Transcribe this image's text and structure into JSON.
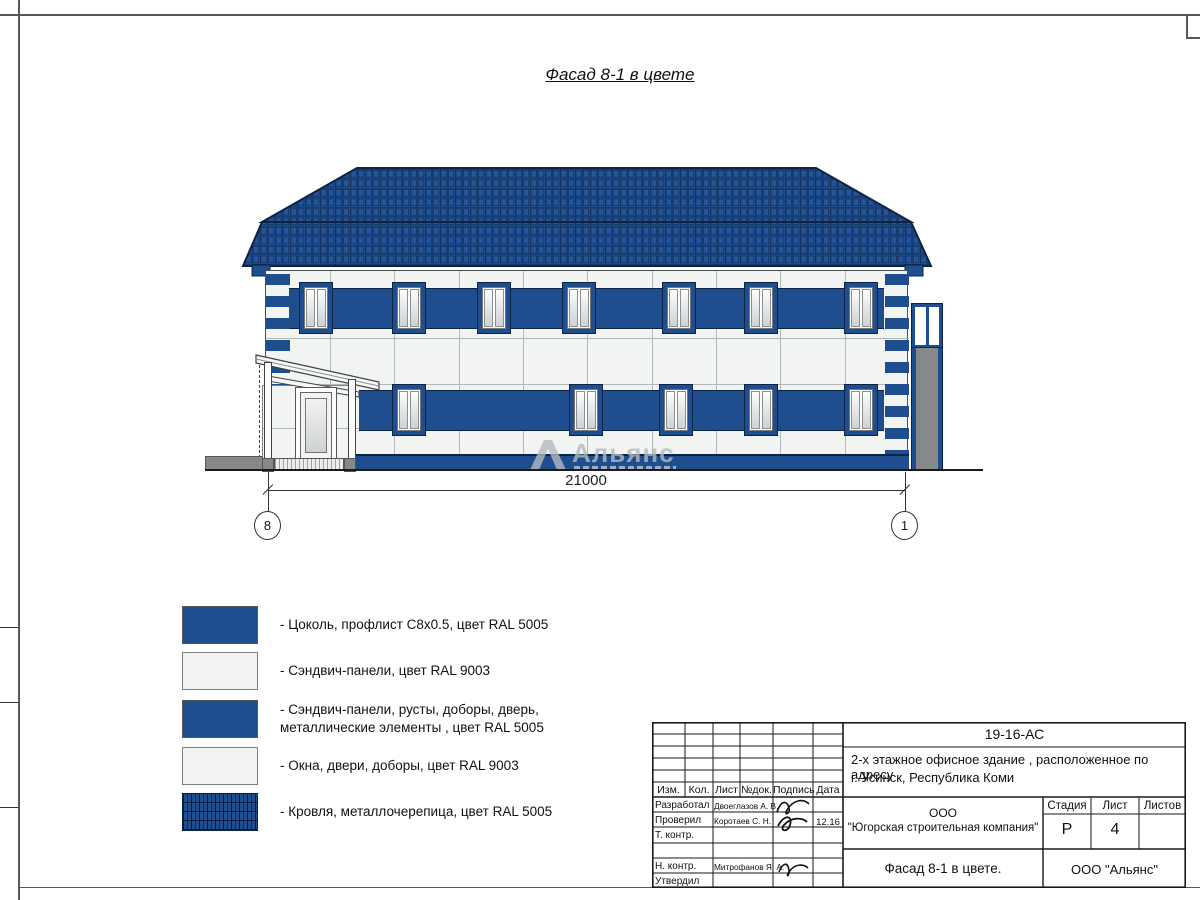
{
  "page": {
    "drawing_title": "Фасад 8-1 в цвете"
  },
  "drawing": {
    "dimension_label": "21000",
    "axis_left": "8",
    "axis_right": "1",
    "watermark": "Альянс"
  },
  "colors": {
    "ral5005_blue": "#1F4E8F",
    "ral9003_white": "#F2F4F1",
    "roof_line": "#0d2345",
    "gray": "#868889"
  },
  "legend": {
    "items": [
      {
        "swatch": "blue",
        "lines": [
          "- Цоколь, профлист С8х0.5, цвет RAL 5005",
          ""
        ]
      },
      {
        "swatch": "white",
        "lines": [
          "- Сэндвич-панели, цвет RAL 9003",
          ""
        ]
      },
      {
        "swatch": "blue",
        "lines": [
          "- Сэндвич-панели, русты, доборы, дверь,",
          "металлические элементы , цвет RAL 5005"
        ]
      },
      {
        "swatch": "white",
        "lines": [
          "- Окна, двери, доборы, цвет RAL 9003",
          ""
        ]
      },
      {
        "swatch": "roof",
        "lines": [
          "- Кровля, металлочерепица, цвет RAL 5005",
          ""
        ]
      }
    ]
  },
  "title_block": {
    "code": "19-16-АС",
    "object_line1": "2-х этажное офисное здание , расположенное по адресу",
    "object_line2": "г. Усинск, Республика Коми",
    "header_cols": [
      "Изм.",
      "Кол.",
      "Лист",
      "№док.",
      "Подпись",
      "Дата"
    ],
    "rows": [
      {
        "role": "Разработал",
        "name": "Двоеглазов А. В.",
        "date": ""
      },
      {
        "role": "Проверил",
        "name": "Коротаев С. Н.",
        "date": "12.16"
      },
      {
        "role": "Т. контр.",
        "name": "",
        "date": ""
      },
      {
        "role": "",
        "name": "",
        "date": ""
      },
      {
        "role": "Н. контр.",
        "name": "Митрофанов Я. А.",
        "date": ""
      },
      {
        "role": "Утвердил",
        "name": "",
        "date": ""
      }
    ],
    "company_line1": "ООО",
    "company_line2": "\"Югорская строительная компания\"",
    "stage_label": "Стадия",
    "sheet_label": "Лист",
    "sheets_label": "Листов",
    "stage_value": "Р",
    "sheet_value": "4",
    "sheets_value": "",
    "sheet_title": "Фасад 8-1 в цвете.",
    "org": "ООО \"Альянс\""
  }
}
